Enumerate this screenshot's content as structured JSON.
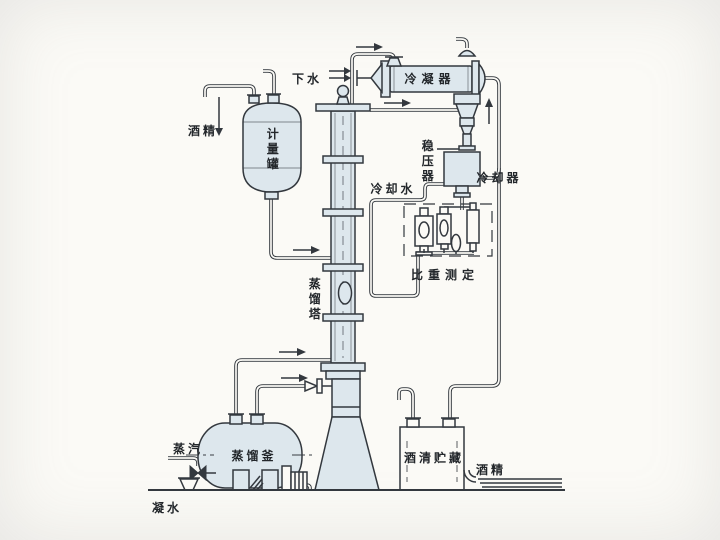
{
  "diagram": {
    "title": "alcohol-distillation-process-flow-diagram",
    "labels": {
      "down_water": "下水",
      "condenser": "冷凝器",
      "alcohol_feed": "酒精",
      "metering_tank": "计量罐",
      "pressure_stabilizer": "稳压器",
      "cooling_water": "冷却水",
      "cooler": "冷却器",
      "gravity_measurement": "比重测定",
      "distillation_tower": "蒸馏塔",
      "steam": "蒸汽",
      "distillation_kettle": "蒸馏釜",
      "condensate_water": "凝水",
      "alcohol_storage": "酒清贮藏",
      "alcohol_out": "酒精"
    },
    "colors": {
      "line": "#33383e",
      "vessel_fill": "#dde7ed",
      "paper": "#fbfaf6"
    }
  }
}
